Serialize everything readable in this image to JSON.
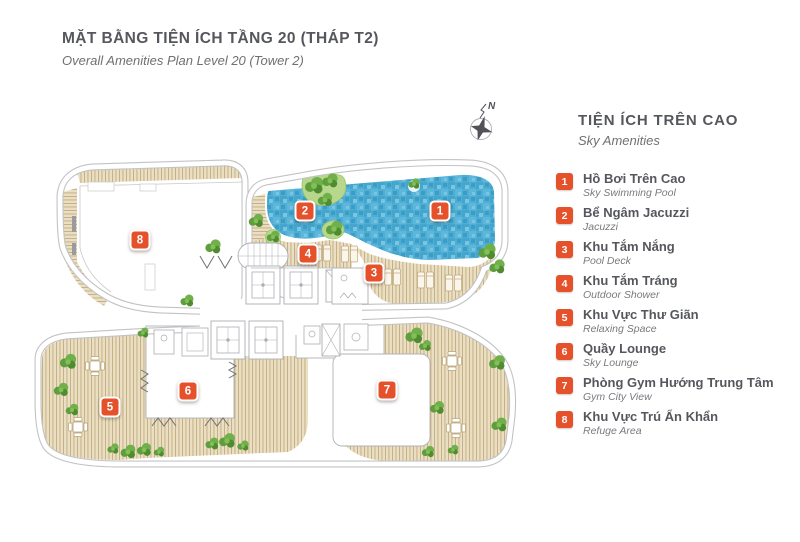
{
  "header": {
    "title": "MẶT BẰNG TIỆN ÍCH TẦNG 20 (THÁP T2)",
    "subtitle": "Overall Amenities Plan Level 20 (Tower 2)"
  },
  "compass": {
    "label": "N"
  },
  "legend": {
    "title": "TIỆN ÍCH TRÊN CAO",
    "subtitle": "Sky Amenities",
    "items": [
      {
        "num": "1",
        "vi": "Hồ Bơi Trên Cao",
        "en": "Sky Swimming Pool"
      },
      {
        "num": "2",
        "vi": "Bể Ngâm Jacuzzi",
        "en": "Jacuzzi"
      },
      {
        "num": "3",
        "vi": "Khu Tắm Nắng",
        "en": "Pool Deck"
      },
      {
        "num": "4",
        "vi": "Khu Tắm Tráng",
        "en": "Outdoor Shower"
      },
      {
        "num": "5",
        "vi": "Khu Vực Thư Giãn",
        "en": "Relaxing Space"
      },
      {
        "num": "6",
        "vi": "Quầy Lounge",
        "en": "Sky Lounge"
      },
      {
        "num": "7",
        "vi": "Phòng Gym Hướng Trung Tâm",
        "en": "Gym City View"
      },
      {
        "num": "8",
        "vi": "Khu Vực Trú Ẩn Khẩn",
        "en": "Refuge Area"
      }
    ]
  },
  "plan": {
    "markers": [
      "1",
      "2",
      "3",
      "4",
      "5",
      "6",
      "7",
      "8"
    ]
  },
  "colors": {
    "accent": "#E5512B",
    "pool_water": "#4FAED4",
    "wood_deck": "#EBDFC3",
    "tree_green": "#6FB04A",
    "outline_gray": "#C2C3C6",
    "text_dark": "#55575C"
  }
}
